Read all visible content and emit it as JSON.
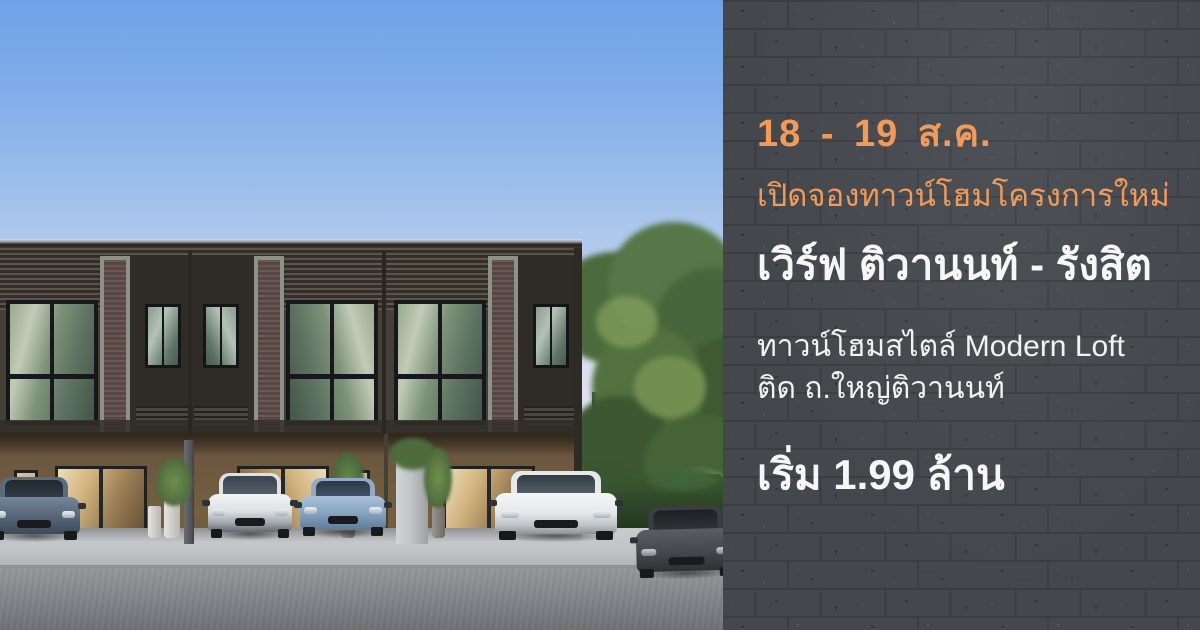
{
  "panel": {
    "date_range": "18 - 19 ส.ค.",
    "announcement": "เปิดจองทาวน์โฮมโครงการใหม่",
    "project_name": "เวิร์ฟ ติวานนท์ - รังสิต",
    "description_line1": "ทาวน์โฮมสไตล์ Modern Loft",
    "description_line2": "ติด ถ.ใหญ่ติวานนท์",
    "price": "เริ่ม 1.99 ล้าน",
    "colors": {
      "panel_background": "#43464B",
      "brick_mortar": "#3C3E43",
      "accent_orange": "#F09A5C",
      "text_white": "#F6F6F6"
    }
  },
  "photo": {
    "subject": "two-storey-modern-loft-townhome-render",
    "cars": [
      "dark-blue-mini",
      "white-crossover",
      "light-blue-sedan",
      "white-suv",
      "dark-grey-sedan"
    ],
    "colors": {
      "sky_top": "#6FA2E8",
      "sky_horizon": "#E6E3EE",
      "facade_upper": "#453F38",
      "facade_ground": "#74603F",
      "accent_frame": "#8C9286",
      "brick_pillar": "#63504B",
      "road": "#84888C",
      "tree_green": "#4C6B3D"
    }
  }
}
